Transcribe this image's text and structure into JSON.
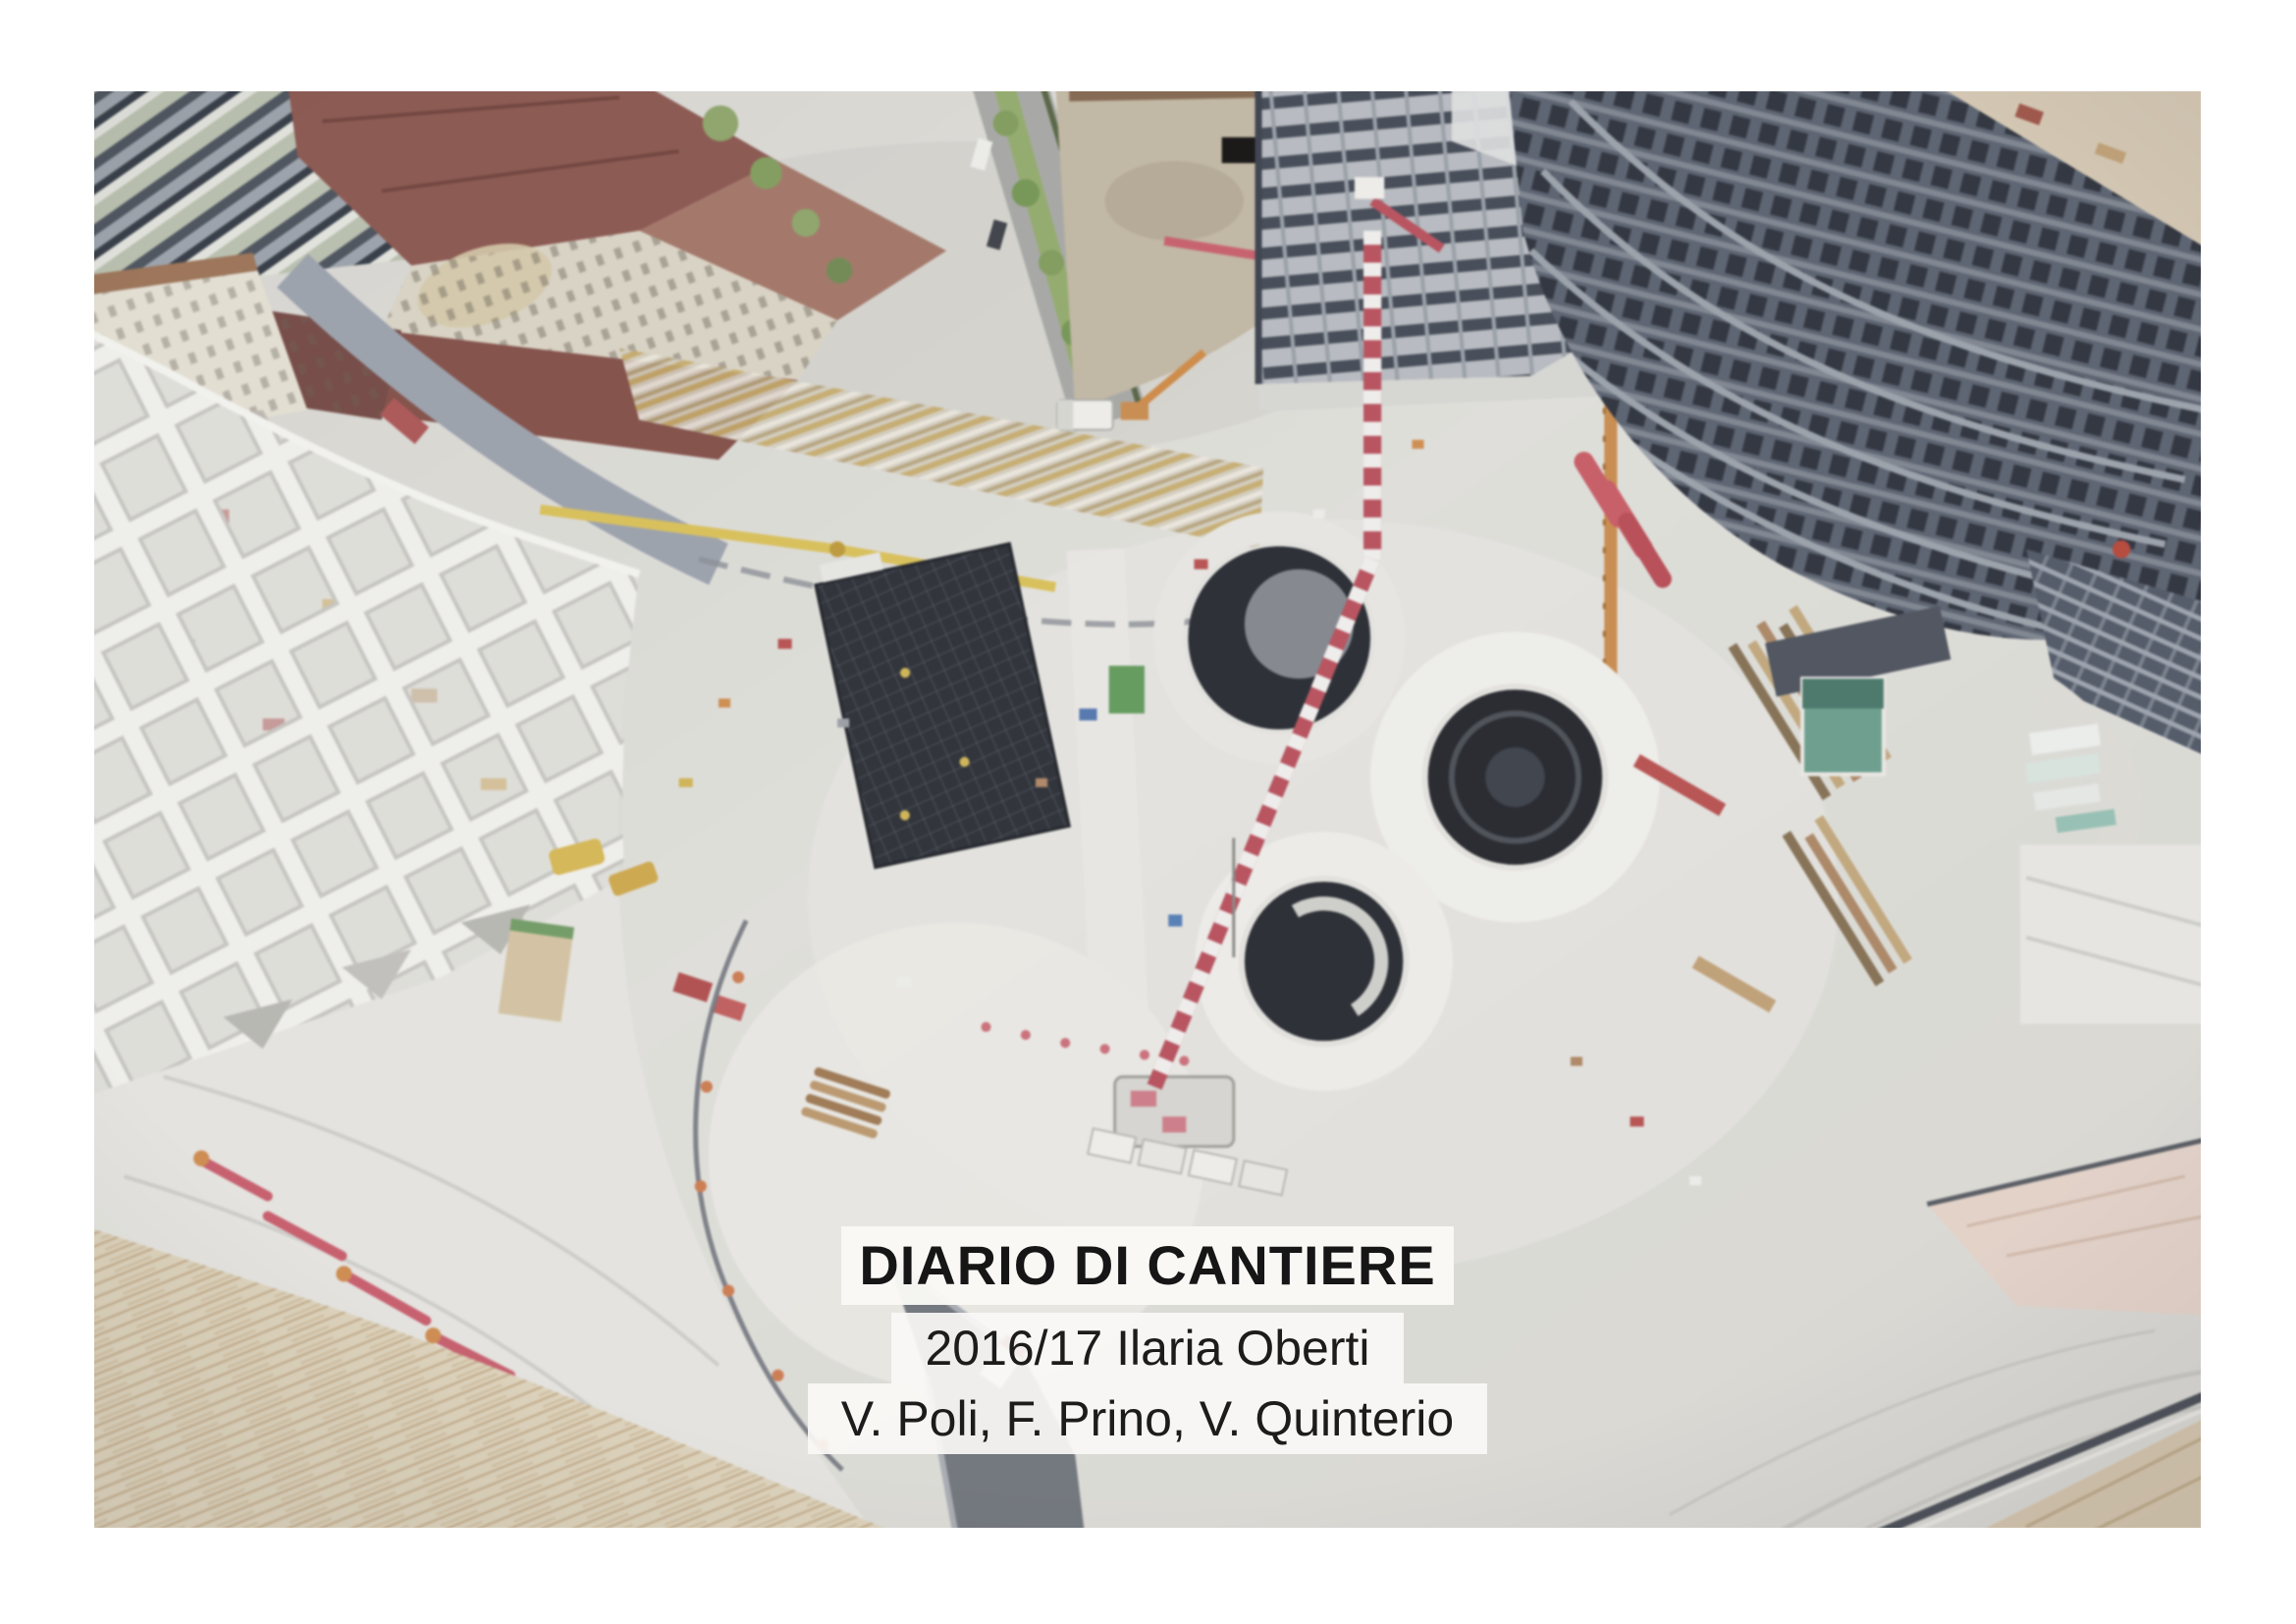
{
  "cover": {
    "title": "DIARIO DI CANTIERE",
    "author_line_1": "2016/17 Ilaria Oberti",
    "author_line_2": "V. Poli, F. Prino, V. Quinterio"
  },
  "photo": {
    "subject": "aerial-view-of-circular-construction-site",
    "palette": {
      "deck_gray": "#dcdbd6",
      "roof_red": "#96544a",
      "crane_red": "#cf4a5a",
      "crane_orange": "#d98a3a",
      "shell_white": "#efeee9",
      "dark_structure": "#525b68",
      "rebar_mat": "#2b2f38",
      "vegetation": "#8aa85c",
      "caption_box": "#faf9f6",
      "caption_text": "#1a1a1a"
    }
  }
}
